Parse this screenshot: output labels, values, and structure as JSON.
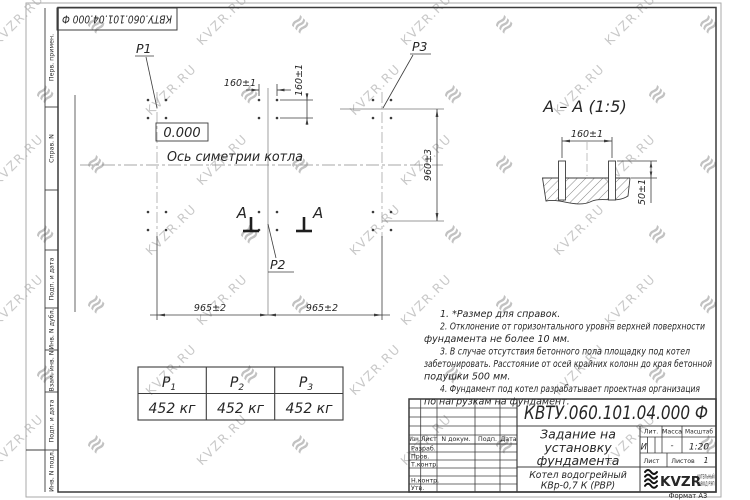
{
  "sheet": {
    "doc_number_rotated": "КВТУ.060.101.04.000 Ф",
    "format_label": "Формат А3"
  },
  "margin_labels": {
    "perv_primen": "Перв. примен.",
    "sprav_n": "Справ. N",
    "podp_data_1": "Подп. и дата",
    "inv_n_dubl": "Инв. N дубл.",
    "vzam_inv_n": "Взам. инв. N",
    "podp_data_2": "Подп. и дата",
    "inv_n_podl": "Инв. N подл."
  },
  "plan": {
    "label_p1": "P1",
    "label_p2": "P2",
    "label_p3": "P3",
    "elevation": "0.000",
    "axis_label": "Ось симетрии котла",
    "dim_bolt_x": "160±1",
    "dim_bolt_y": "160±1",
    "dim_width": "960±3",
    "dim_span_left": "965±2",
    "dim_span_right": "965±2",
    "section_letter": "А"
  },
  "section_view": {
    "title": "А – А (1:5)",
    "dim_spacing": "160±1",
    "dim_protrusion": "50±1"
  },
  "notes": {
    "lines": [
      "1. *Размер для справок.",
      "2. Отклонение от горизонтального уровня верхней поверхности",
      "фундамента не более 10 мм.",
      "3. В случае отсутствия бетонного пола площадку под котел",
      "забетонировать. Расстояние от осей крайних колонн до края бетонной",
      "подушки 500 мм.",
      "4. Фундамент под котел разрабатывает проектная организация",
      "по нагрузкам на фундамент."
    ]
  },
  "load_table": {
    "headers": [
      {
        "name": "P",
        "sub": "1"
      },
      {
        "name": "P",
        "sub": "2"
      },
      {
        "name": "P",
        "sub": "3"
      }
    ],
    "values": [
      "452 кг",
      "452 кг",
      "452 кг"
    ]
  },
  "title_block": {
    "doc_number": "КВТУ.060.101.04.000 Ф",
    "title_lines": [
      "Задание на",
      "установку",
      "фундамента"
    ],
    "product_lines": [
      "Котел водогрейный",
      "КВр-0,7 К (РВР)"
    ],
    "col_izm": "Изм.",
    "col_list": "Лист",
    "col_n_dokum": "N докум.",
    "col_podp": "Подп.",
    "col_data": "Дата",
    "row_razrab": "Разраб.",
    "row_prov": "Пров.",
    "row_tkontr": "Т.контр.",
    "row_nkontr": "Н.контр.",
    "row_utv": "Утв.",
    "lit_label": "Лит.",
    "massa_label": "Масса",
    "masshtab_label": "Масштаб",
    "lit_value": "И",
    "massa_value": "-",
    "masshtab_value": "1:20",
    "list_label": "Лист",
    "listov_label": "Листов",
    "listov_value": "1",
    "logo_text": "KVZR",
    "logo_line1": "КОТЕЛЬНЫЙ",
    "logo_line2": "ЗАВОД РЭП"
  },
  "watermark": {
    "text": "KVZR.RU",
    "icon_glyph": "≋"
  },
  "colors": {
    "line": "#3c3c3c",
    "watermark": "#c9c9c9"
  }
}
